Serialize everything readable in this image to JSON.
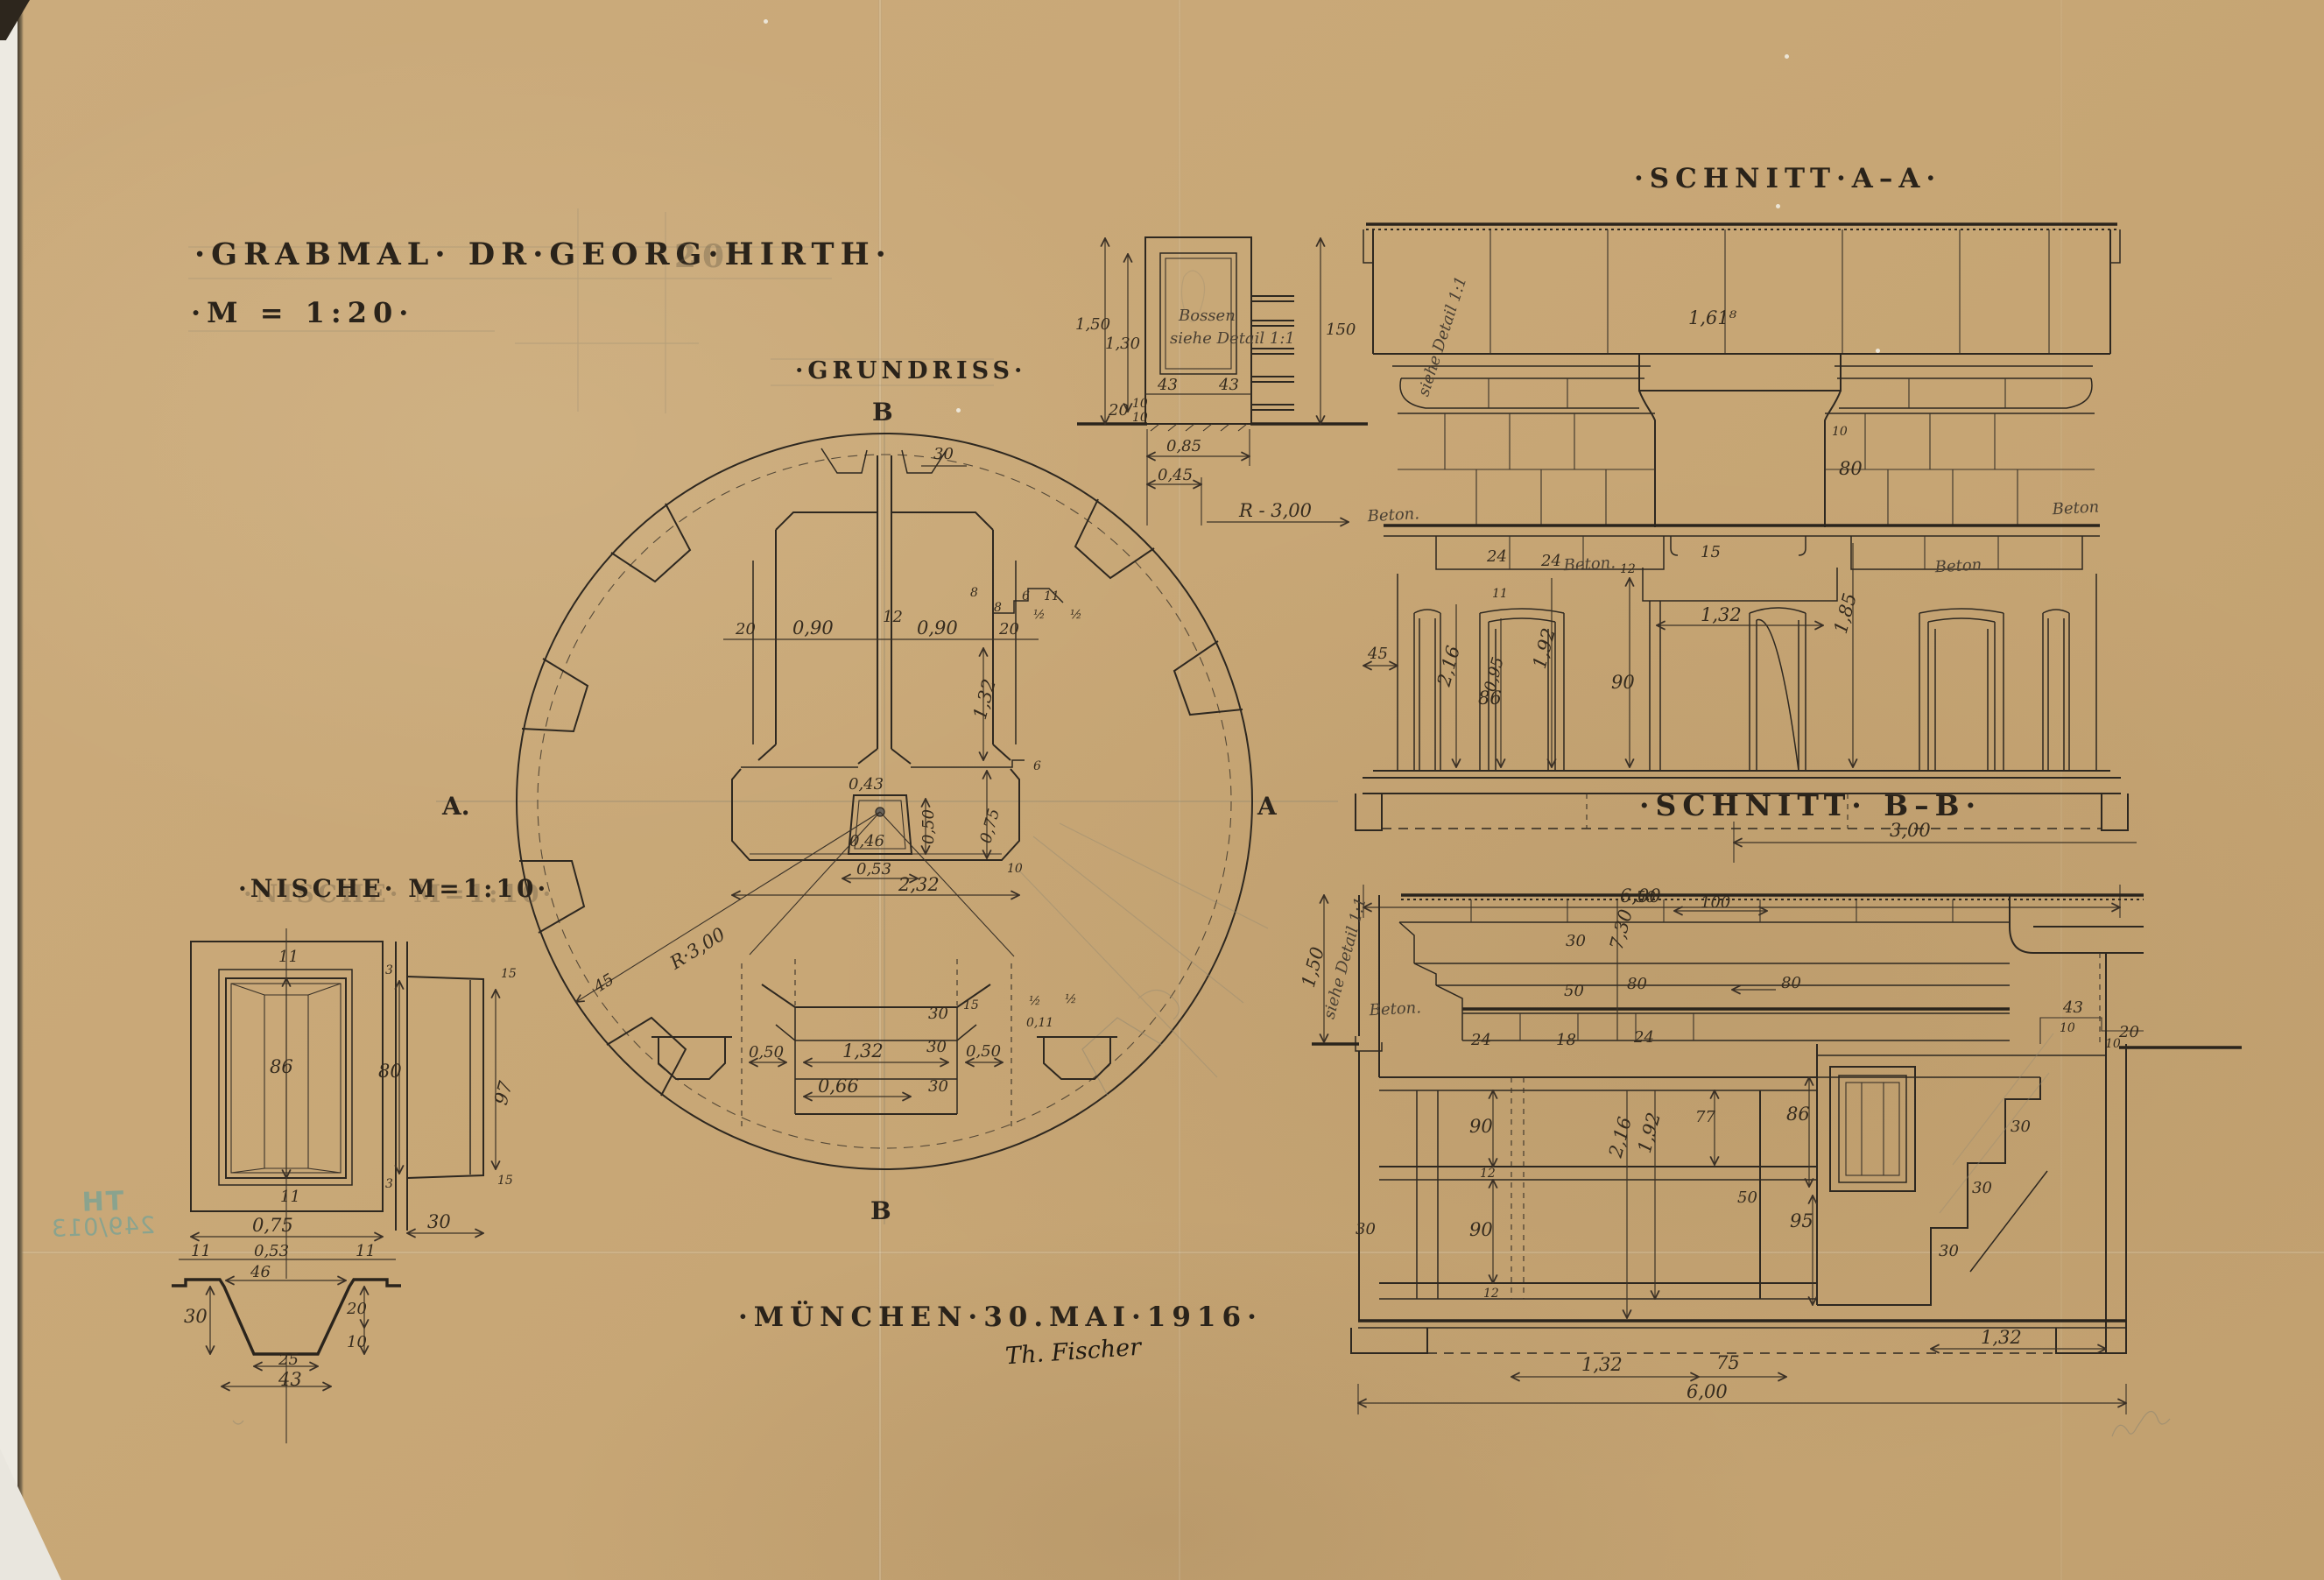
{
  "document": {
    "title": "·GRABMAL·  DR·GEORG·HIRTH·",
    "scale": "·M = 1:20·",
    "ghost_note": "20",
    "place_date": "·MÜNCHEN·30.MAI·1916·",
    "signature": "Th. Fischer",
    "stamp": {
      "line1": "TH",
      "line2": "249/013",
      "color": "#7ba394"
    },
    "paper_color": "#c8a776",
    "ink_color": "#2e2820"
  },
  "grundriss": {
    "title": "·GRUNDRISS·",
    "marker_top": "B",
    "marker_bottom": "B",
    "marker_left": "A.",
    "marker_right": "A",
    "dims": [
      "30",
      "20",
      "0,90",
      "12",
      "0,90",
      "20",
      "8",
      "8",
      "6",
      "11",
      "½",
      "½",
      "1,32",
      "6",
      "0,43",
      "0,50",
      "0,75",
      "0,46",
      "0,53",
      "2,32",
      "10",
      "R·3,00",
      "45",
      "0,50",
      "1,32",
      "0,50",
      "0,66",
      "30",
      "30",
      "30",
      "15",
      "0,11",
      "½",
      "½"
    ]
  },
  "pillar_detail": {
    "note_line1": "Bossen",
    "note_line2": "siehe Detail 1:1",
    "dims": [
      "1,50",
      "1,30",
      "150",
      "43",
      "43",
      "20",
      "10",
      "10",
      "0,85",
      "0,45",
      "R - 3,00"
    ]
  },
  "schnitt_aa": {
    "title": "·SCHNITT·A–A·",
    "beton_labels": [
      "Beton.",
      "Beton.",
      "Beton",
      "Beton"
    ],
    "detail_note": "siehe Detail 1:1",
    "dims": [
      "1,61⁸",
      "10",
      "80",
      "15",
      "24",
      "24",
      "11",
      "1,32",
      "86",
      "90",
      "45",
      "2,16",
      "0,95",
      "1,92",
      "12",
      "1,85",
      "6,00"
    ]
  },
  "schnitt_bb": {
    "title": "·SCHNITT· B–B·",
    "beton_label": "Beton.",
    "detail_note": "siehe Detail 1:1",
    "dims": [
      "3,00",
      "1,50",
      "7,30",
      "50",
      "100",
      "30",
      "50",
      "80",
      "80",
      "24",
      "18",
      "24",
      "90",
      "12",
      "90",
      "12",
      "30",
      "2,16",
      "1,92",
      "77",
      "50",
      "86",
      "95",
      "43",
      "10",
      "20",
      "10",
      "30",
      "30",
      "30",
      "1,32",
      "75",
      "1,32",
      "6,00"
    ]
  },
  "nische": {
    "title": "·NISCHE· M=1:10·",
    "dims": [
      "11",
      "86",
      "11",
      "3",
      "80",
      "3",
      "97",
      "15",
      "15",
      "30",
      "0,75",
      "11",
      "0,53",
      "11",
      "46",
      "30",
      "20",
      "10",
      "25",
      "43"
    ]
  }
}
